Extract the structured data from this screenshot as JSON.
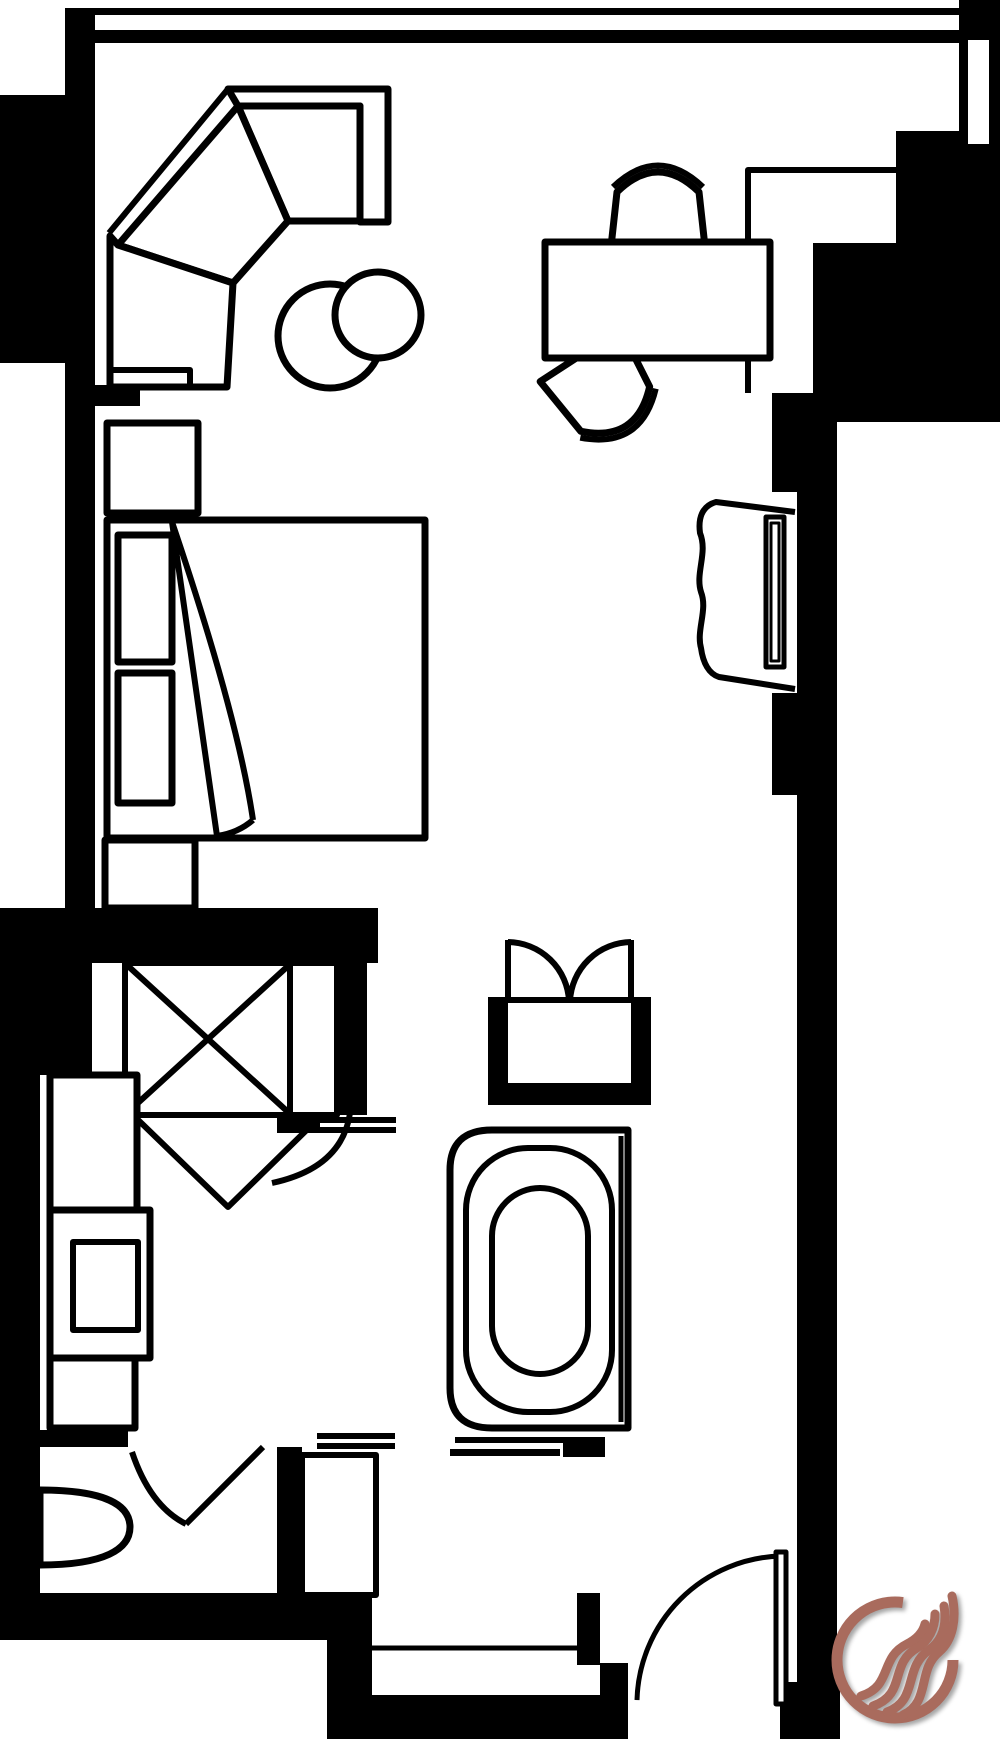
{
  "meta": {
    "title": "Hotel guest room floor plan",
    "background_color": "#ffffff",
    "line_color": "#000000"
  },
  "logo": {
    "name": "flame-logo",
    "color": "#a96b5d",
    "shadow_color": "rgba(0,0,0,0.35)",
    "ring_gap_position": "top-right"
  },
  "areas": {
    "bedroom": {
      "label": "Bedroom"
    },
    "sitting_area": {
      "label": "Sitting area"
    },
    "desk_area": {
      "label": "Work desk area"
    },
    "closet": {
      "label": "Closet"
    },
    "bathroom": {
      "label": "Bathroom"
    },
    "toilet_room": {
      "label": "Toilet room"
    },
    "entry": {
      "label": "Entry vestibule"
    }
  },
  "fixtures": {
    "window_wall": {
      "label": "Window wall"
    },
    "walls": {
      "label": "Walls"
    },
    "sofa": {
      "label": "Corner sectional sofa"
    },
    "side_table": {
      "label": "Round side table"
    },
    "stool": {
      "label": "Round stool"
    },
    "desk": {
      "label": "Writing desk"
    },
    "desk_chair": {
      "label": "Desk chair"
    },
    "lounge_chair": {
      "label": "Angled lounge chair"
    },
    "bed": {
      "label": "Bed with turned-down sheet"
    },
    "pillows": {
      "label": "Pillows"
    },
    "nightstand_upper": {
      "label": "Nightstand"
    },
    "nightstand_lower": {
      "label": "Nightstand"
    },
    "tv_console": {
      "label": "TV console"
    },
    "tv": {
      "label": "Television"
    },
    "tv_niche": {
      "label": "TV wall niche"
    },
    "alcove": {
      "label": "Wardrobe alcove"
    },
    "window_slot": {
      "label": "Side window"
    },
    "closet_box": {
      "label": "Closet with luggage rack"
    },
    "closet_door": {
      "label": "Closet door"
    },
    "shower": {
      "label": "Shower stall"
    },
    "shower_doors": {
      "label": "Glass double doors"
    },
    "bathtub": {
      "label": "Bathtub"
    },
    "vanity": {
      "label": "Vanity with sink"
    },
    "toilet": {
      "label": "Toilet"
    },
    "toilet_door": {
      "label": "Toilet room door"
    },
    "bath_door_leaf": {
      "label": "Bathroom door leaf"
    },
    "pocket_door_1": {
      "label": "Pocket door track"
    },
    "pocket_door_2": {
      "label": "Pocket door track"
    },
    "pocket_door_3": {
      "label": "Pocket door track"
    },
    "entry_door": {
      "label": "Entry door"
    },
    "entry_sill": {
      "label": "Entry sill"
    }
  }
}
